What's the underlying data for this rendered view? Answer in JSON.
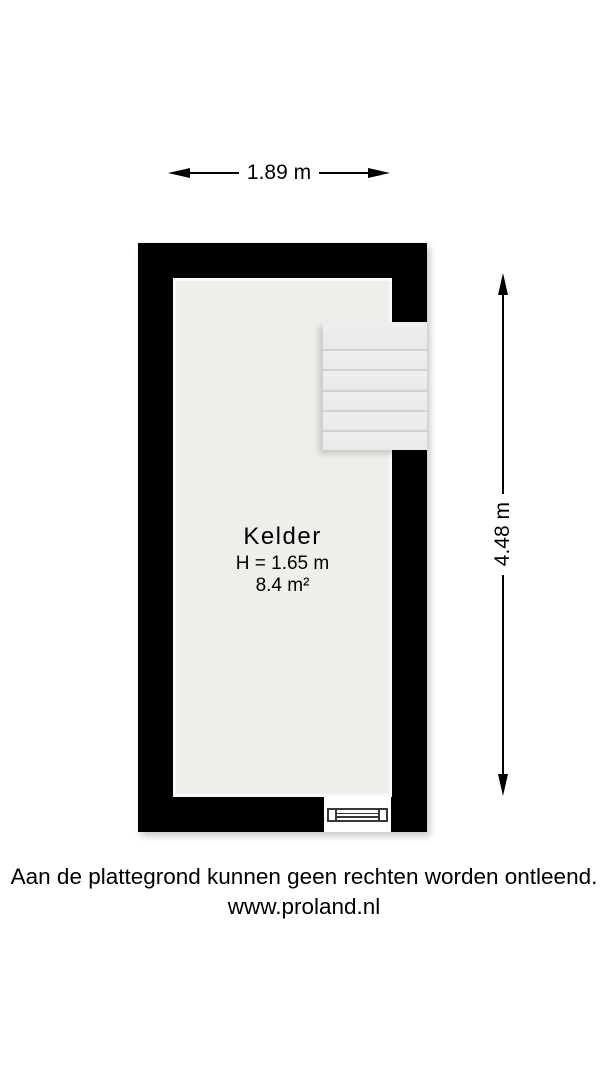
{
  "page": {
    "background": "#ffffff"
  },
  "floorplan": {
    "room": {
      "name": "Kelder",
      "ceiling_height": "H = 1.65 m",
      "area": "8.4 m²"
    },
    "dimensions": {
      "width": "1.89 m",
      "height": "4.48 m"
    },
    "stairs": {
      "treads": 6
    },
    "colors": {
      "wall": "#000000",
      "floor": "#f0eee8",
      "stairs_fill": "#ededed",
      "stair_line": "#d2d2d2",
      "window_stroke": "#383838",
      "ink": "#000000"
    }
  },
  "footer": {
    "disclaimer": "Aan de plattegrond kunnen geen rechten worden ontleend.",
    "website": "www.proland.nl"
  }
}
